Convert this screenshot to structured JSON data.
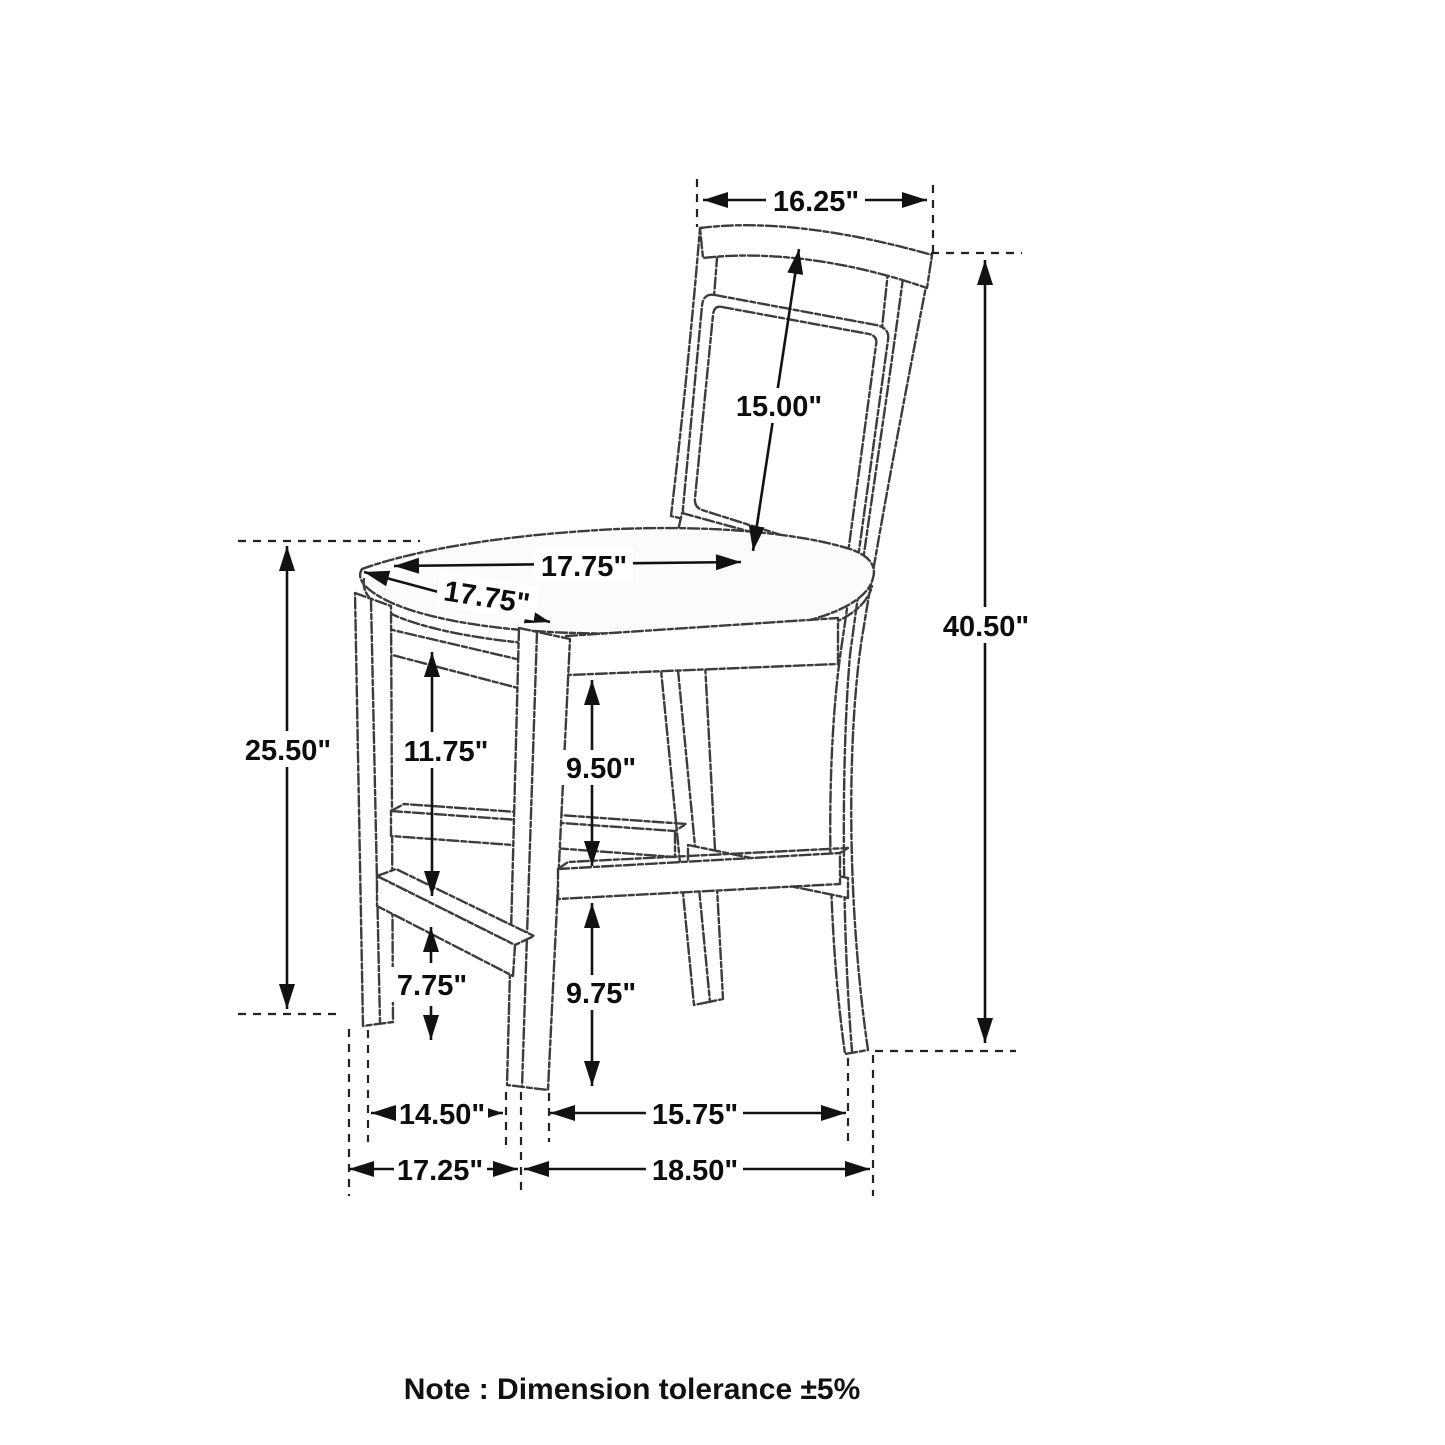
{
  "diagram": {
    "subject": "counter-height dining chair dimension drawing",
    "ink_color": "#1a1a1a",
    "note": "Note : Dimension tolerance ±5%",
    "dimensions": {
      "back_width_top": "16.25\"",
      "back_panel_height": "15.00\"",
      "overall_height": "40.50\"",
      "seat_width": "17.75\"",
      "seat_depth": "17.75\"",
      "floor_to_seat_height": "25.50\"",
      "seat_rail_to_front_stretcher": "11.75\"",
      "seat_rail_to_side_stretcher": "9.50\"",
      "front_stretcher_to_floor": "7.75\"",
      "side_stretcher_to_floor": "9.75\"",
      "front_legs_inner_width": "14.50\"",
      "side_legs_inner_depth": "15.75\"",
      "front_width_overall": "17.25\"",
      "side_depth_overall": "18.50\""
    }
  }
}
